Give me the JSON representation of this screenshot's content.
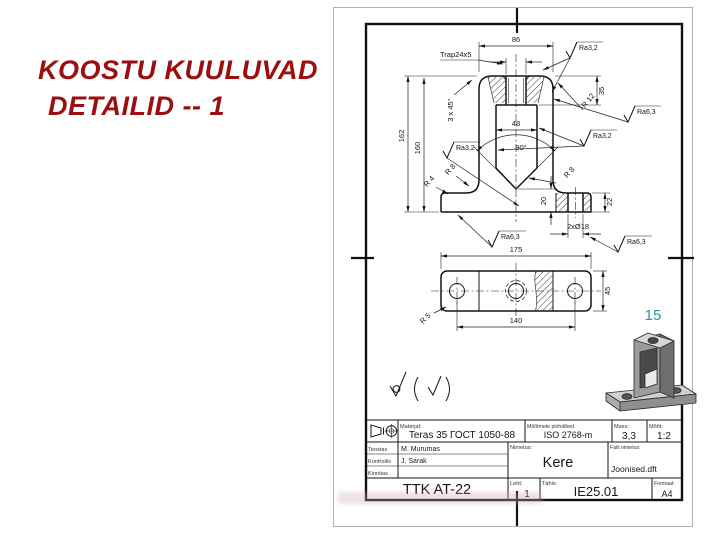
{
  "slide": {
    "title_line1": "KOOSTU KUULUVAD",
    "title_line2": "DETAILID -- 1",
    "page_number": "15"
  },
  "colors": {
    "title_red": "#9d0e0e",
    "page_number_teal": "#2e93a4",
    "drawing_line": "#141414"
  },
  "front_view": {
    "dim_width_top": "86",
    "thread_label": "Trap24x5",
    "chamfer_label": "3 x 45°",
    "dim_height_outer": "162",
    "dim_height_inner": "160",
    "dim_thread_depth": "35",
    "dim_cavity_width": "48",
    "angle_label": "90°",
    "fillet_r12": "R 12",
    "fillet_r8_left": "R 8",
    "fillet_r8_center": "R 8",
    "fillet_r4": "R 4",
    "dim_notch": "20",
    "dim_base_height": "22",
    "dim_base_holes": "2xØ18",
    "ra_top": "Ra3,2",
    "ra_right_upper": "Ra6,3",
    "ra_right_mid": "Ra3,2",
    "ra_left": "Ra3,2",
    "ra_bottom_left": "Ra6,3",
    "ra_bottom_right": "Ra6,3"
  },
  "top_view": {
    "dim_length": "175",
    "dim_hole_spacing": "140",
    "dim_width": "45",
    "fillet_r5": "R 5"
  },
  "title_block": {
    "material_label": "Materjal:",
    "material_value": "Teras 35 ГОСТ 1050-88",
    "tolerance_label": "Mõõtmete piirhälbed",
    "tolerance_value": "ISO 2768-m",
    "mass_label": "Mass:",
    "mass_value": "3,3",
    "scale_label": "Mõõt:",
    "scale_value": "1:2",
    "made_label": "Teostas",
    "made_value": "M. Murumas",
    "checked_label": "Kontrollis",
    "checked_value": "J. Sarak",
    "approved_label": "Kinnitas",
    "approved_value": "",
    "name_label": "Nimetus:",
    "name_value": "Kere",
    "file_label": "Faili nimetus:",
    "file_value": "Joonised.dft",
    "org": "TTK  AT-22",
    "sheet_label": "Leht:",
    "sheet_value": "1",
    "code_label": "Tähis:",
    "code_value": "IE25.01",
    "format_label": "Formaat:",
    "format_value": "A4"
  }
}
